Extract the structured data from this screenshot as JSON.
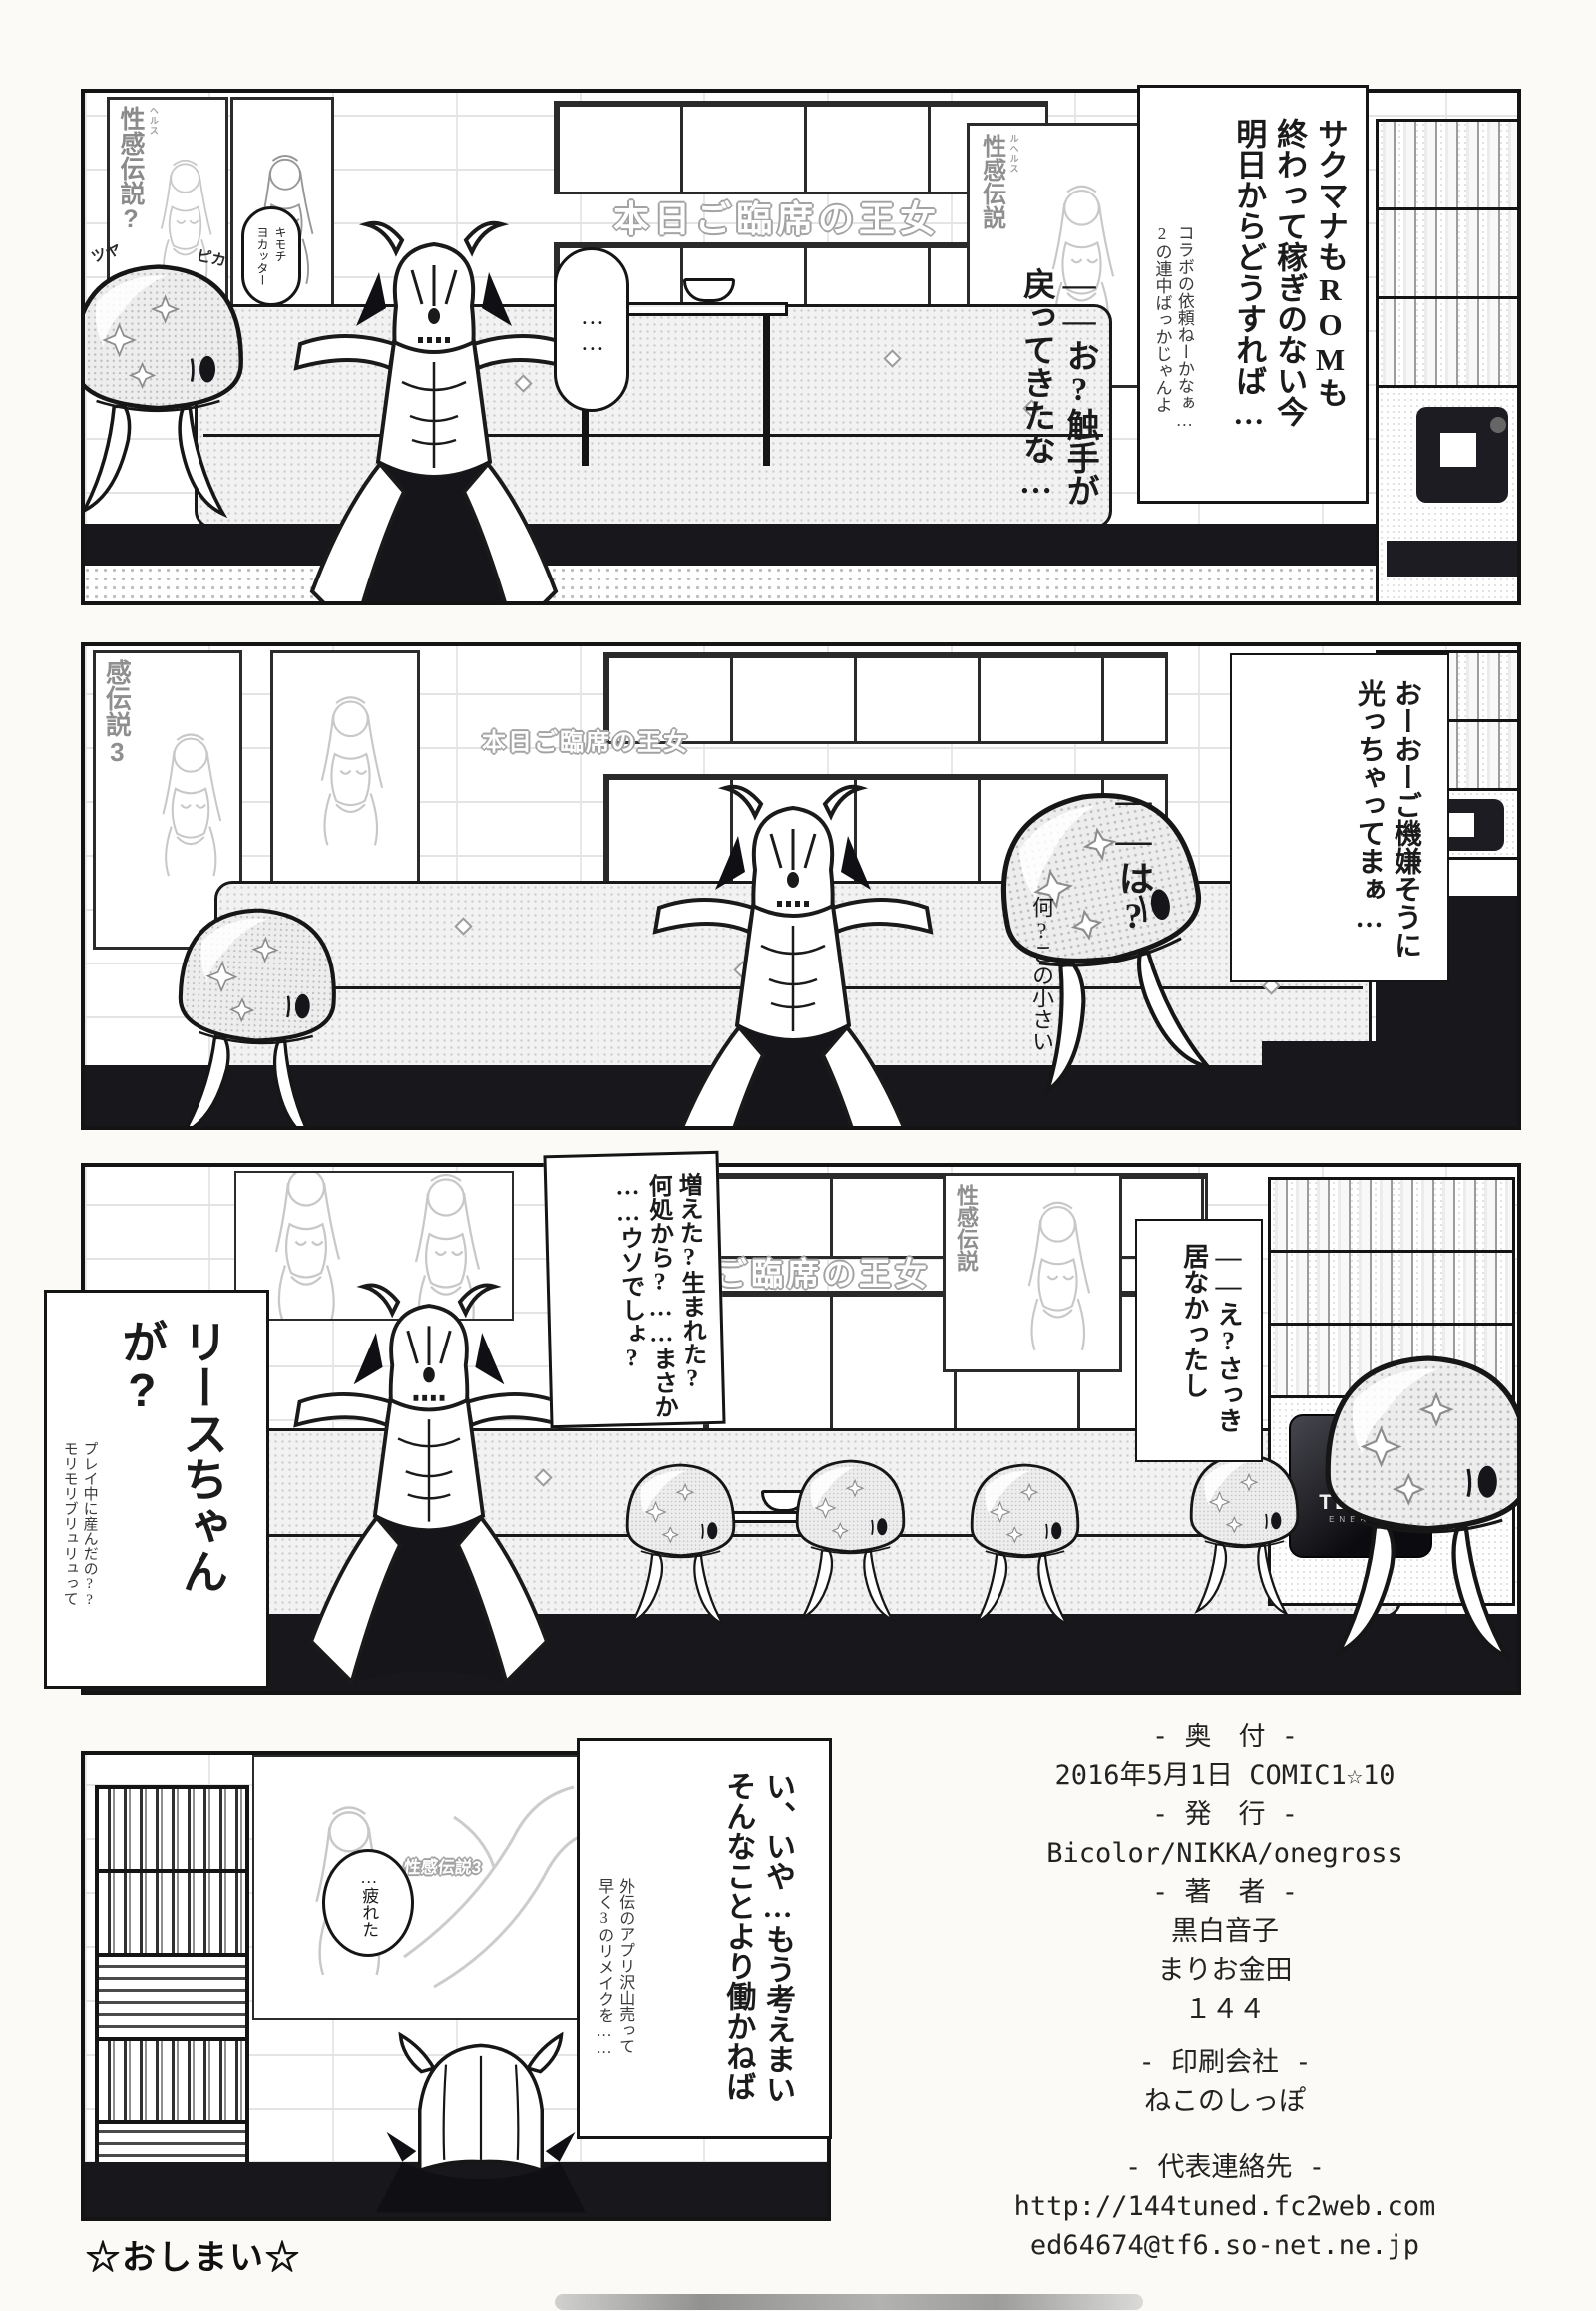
{
  "page": {
    "end_mark": "☆おしまい☆"
  },
  "decor": {
    "banner": "本日ご臨席の王女",
    "poster_q_title": "性感伝説?",
    "poster_q_ruby": "ヘルス",
    "poster_plain_title": "性感伝説",
    "poster_plain_ruby": "ルヘルス",
    "poster3_title": "感伝説3",
    "logo3": "性感伝説3",
    "tenta_logo": "TENTA",
    "tenta_sub": "ENERGY"
  },
  "panel1": {
    "sfx_left": "ツヤ",
    "sfx_right": "ピカ",
    "slime_speech": [
      "キモチ",
      "ヨカッター"
    ],
    "silence": "……",
    "monologue": [
      "サクマナもROMも",
      "終わって稼ぎのない今",
      "明日からどうすれば…"
    ],
    "monologue_small": [
      "コラボの依頼ねーかなぁ…",
      "2の連中ばっかじゃんよ"
    ],
    "speech": [
      "——お?触手が",
      "戻ってきたな…"
    ]
  },
  "panel2": {
    "speech": [
      "おーおーご機嫌そうに",
      "光っちゃってまぁ…"
    ],
    "reply": "——は?",
    "aside": "何?この小さい"
  },
  "panel3": {
    "balloon": [
      "増えた?生まれた?",
      "何処から?……まさか",
      "……ウソでしょ?"
    ],
    "speech": [
      "——え?さっき",
      "居なかったし"
    ],
    "headline": "リースちゃんが?",
    "headline_small": [
      "プレイ中に産んだの??",
      "モリモリブリュリュって"
    ]
  },
  "panel4": {
    "balloon": [
      "い、いや…もう考えまい",
      "そんなことより働かねば"
    ],
    "balloon_small": [
      "外伝のアプリ沢山売って",
      "早く3のリメイクを……"
    ],
    "tired": "…疲れた"
  },
  "colophon": {
    "lines": [
      "- 奥　付 -",
      "2016年5月1日 COMIC1☆10",
      "- 発　行 -",
      "Bicolor/NIKKA/onegross",
      "- 著　者 -",
      "黒白音子",
      "まりお金田",
      "１４４",
      "- 印刷会社 -",
      "ねこのしっぽ",
      "- 代表連絡先 -",
      "http://144tuned.fc2web.com",
      "ed64674@tf6.so-net.ne.jp"
    ]
  }
}
